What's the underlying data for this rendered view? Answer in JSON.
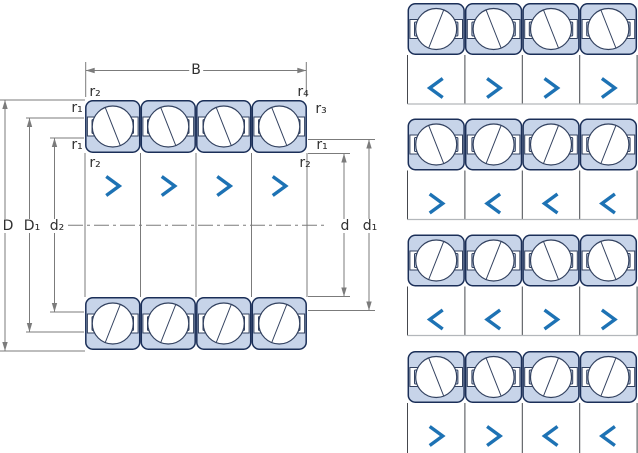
{
  "labels": {
    "B": "B",
    "D": "D",
    "D1": "D₁",
    "d2": "d₂",
    "d": "d",
    "d1": "d₁",
    "r1": "r₁",
    "r2": "r₂",
    "r3": "r₃",
    "r4": "r₄"
  },
  "main_diagram": {
    "description": "quad bearing set cross-section",
    "chevrons": [
      ">",
      ">",
      ">",
      ">"
    ]
  },
  "arrangement_rows": [
    {
      "chevrons": [
        "<",
        ">",
        ">",
        ">"
      ]
    },
    {
      "chevrons": [
        ">",
        "<",
        "<",
        "<"
      ]
    },
    {
      "chevrons": [
        "<",
        "<",
        ">",
        ">"
      ]
    },
    {
      "chevrons": [
        ">",
        ">",
        "<",
        "<"
      ]
    }
  ],
  "colors": {
    "bearing_fill": "#c7d4e9",
    "bearing_outline": "#1b2f58",
    "inner_line": "#32415f",
    "chevron_blue": "#1d72b4",
    "dimension_gray": "#7b7b7b",
    "panel_line_dark": "#45484d",
    "panel_line_light": "#b3b7bb",
    "label_text": "#303030"
  }
}
